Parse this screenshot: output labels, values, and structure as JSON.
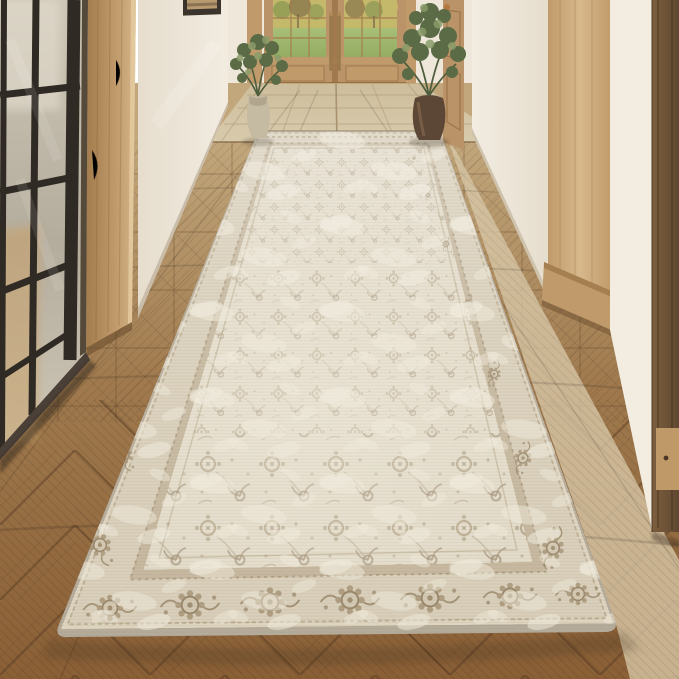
{
  "scene": {
    "kind": "interior-product-photo",
    "subject_label": "distressed vintage floral runner rug in hallway",
    "objects": {
      "rug": "beige distressed floral runner rug",
      "partition": "black steel framed glass partition",
      "post": "oak wall post",
      "left_wall": "white plaster wall",
      "picture": "framed artwork",
      "doors": "oak french doors with glass panes",
      "left_plant": "potted olive tree in beige vase",
      "right_plant": "potted olive tree in brown urn",
      "side_door": "oak side door with brass knob",
      "pillar": "oak door casing pillar",
      "walnut_frame": "dark walnut cabinet frame",
      "floor_near": "herringbone wood plank floor",
      "floor_mid": "square parquet wood floor",
      "floor_far": "light stone tile floor",
      "outdoors": "green lawn and trees seen through door glass"
    },
    "colors": {
      "wallWhite": "#f2ece1",
      "wallShade": "#e6ddcd",
      "wallFar": "#efe8da",
      "trim": "#ddd2c0",
      "oakLight": "#d7b88c",
      "oakMid": "#c09a6a",
      "oakDark": "#a57e4f",
      "doorWood": "#bb9368",
      "doorSeam": "#8a6538",
      "walnut": "#7d5f3e",
      "walnutDark": "#5f4730",
      "frameBlack": "#2f2a23",
      "frameEdge": "#55493a",
      "glassFrost": "#cdc6b6",
      "glassFrostDark": "#b4ac9c",
      "cabinetBehindGlass": "#c9a26b",
      "tileLight": "#d8cbac",
      "tileDark": "#cdbd9c",
      "grout": "#a89270",
      "floorFar": "#c2a77c",
      "floorMid": "#a07a4e",
      "floorNear": "#8a5f36",
      "floorLines": "#4f351d",
      "floorRightLight": "#d9c8a8",
      "rugBinding": "#b5ac9b",
      "rugGuard": "#ded5c1",
      "rugBorder": "#d9cfba",
      "rugInnerGuard": "#c6b89f",
      "rugField": "#e1d9c6",
      "rugLight": "#efe9da",
      "rugMotif": "#a08d6d",
      "rugMotifDark": "#8a775a",
      "grass": "#93ac62",
      "grassLight": "#a8c078",
      "treeYellow": "#c4b96b",
      "treeGreen": "#8d9a54",
      "treeDark": "#6d5b40",
      "foliage": "#5a6b46",
      "foliageLight": "#8a9c6a",
      "potBeige": "#c5baa2",
      "potBrown": "#5c4636",
      "brass": "#9a7a4a",
      "art": "#b79a6f",
      "shadow": "#3a2e1e"
    }
  }
}
